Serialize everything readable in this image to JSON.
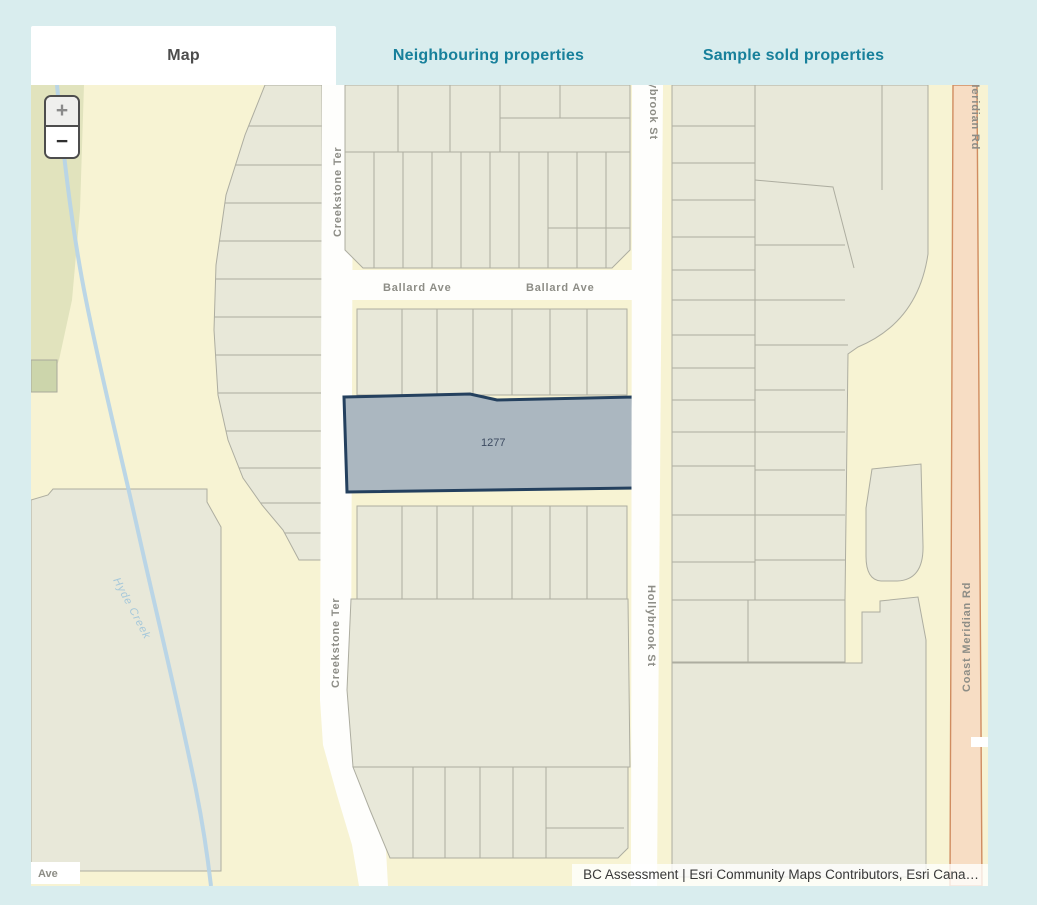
{
  "tabs": {
    "map": "Map",
    "neighbouring": "Neighbouring properties",
    "sample_sold": "Sample sold properties"
  },
  "map": {
    "zoom_in_label": "+",
    "zoom_out_label": "−",
    "selected_parcel": {
      "number": "1277"
    },
    "streets": {
      "creekstone": "Creekstone Ter",
      "hollybrook": "Hollybrook St",
      "ballard": "Ballard Ave",
      "coast_meridian": "Coast Meridian Rd",
      "partial_ave": "Ave"
    },
    "water": {
      "creek": "Hyde Creek"
    },
    "attribution": "BC Assessment | Esri Community Maps Contributors, Esri Cana…"
  },
  "colors": {
    "page_background": "#d9edee",
    "active_tab_text": "#4d4d4d",
    "inactive_tab_text": "#17809b",
    "map_background": "#f7f3d3",
    "parcel_fill": "#e8e8d9",
    "parcel_stroke": "#adada0",
    "greenspace_fill": "#e1e3bd",
    "street_fill": "#fefefc",
    "selected_parcel_fill": "#abb7c0",
    "selected_parcel_stroke": "#24405e",
    "major_road_fill": "#f7ddc4",
    "major_road_stroke": "#d08c60",
    "creek_stroke": "#b7d4e7"
  }
}
